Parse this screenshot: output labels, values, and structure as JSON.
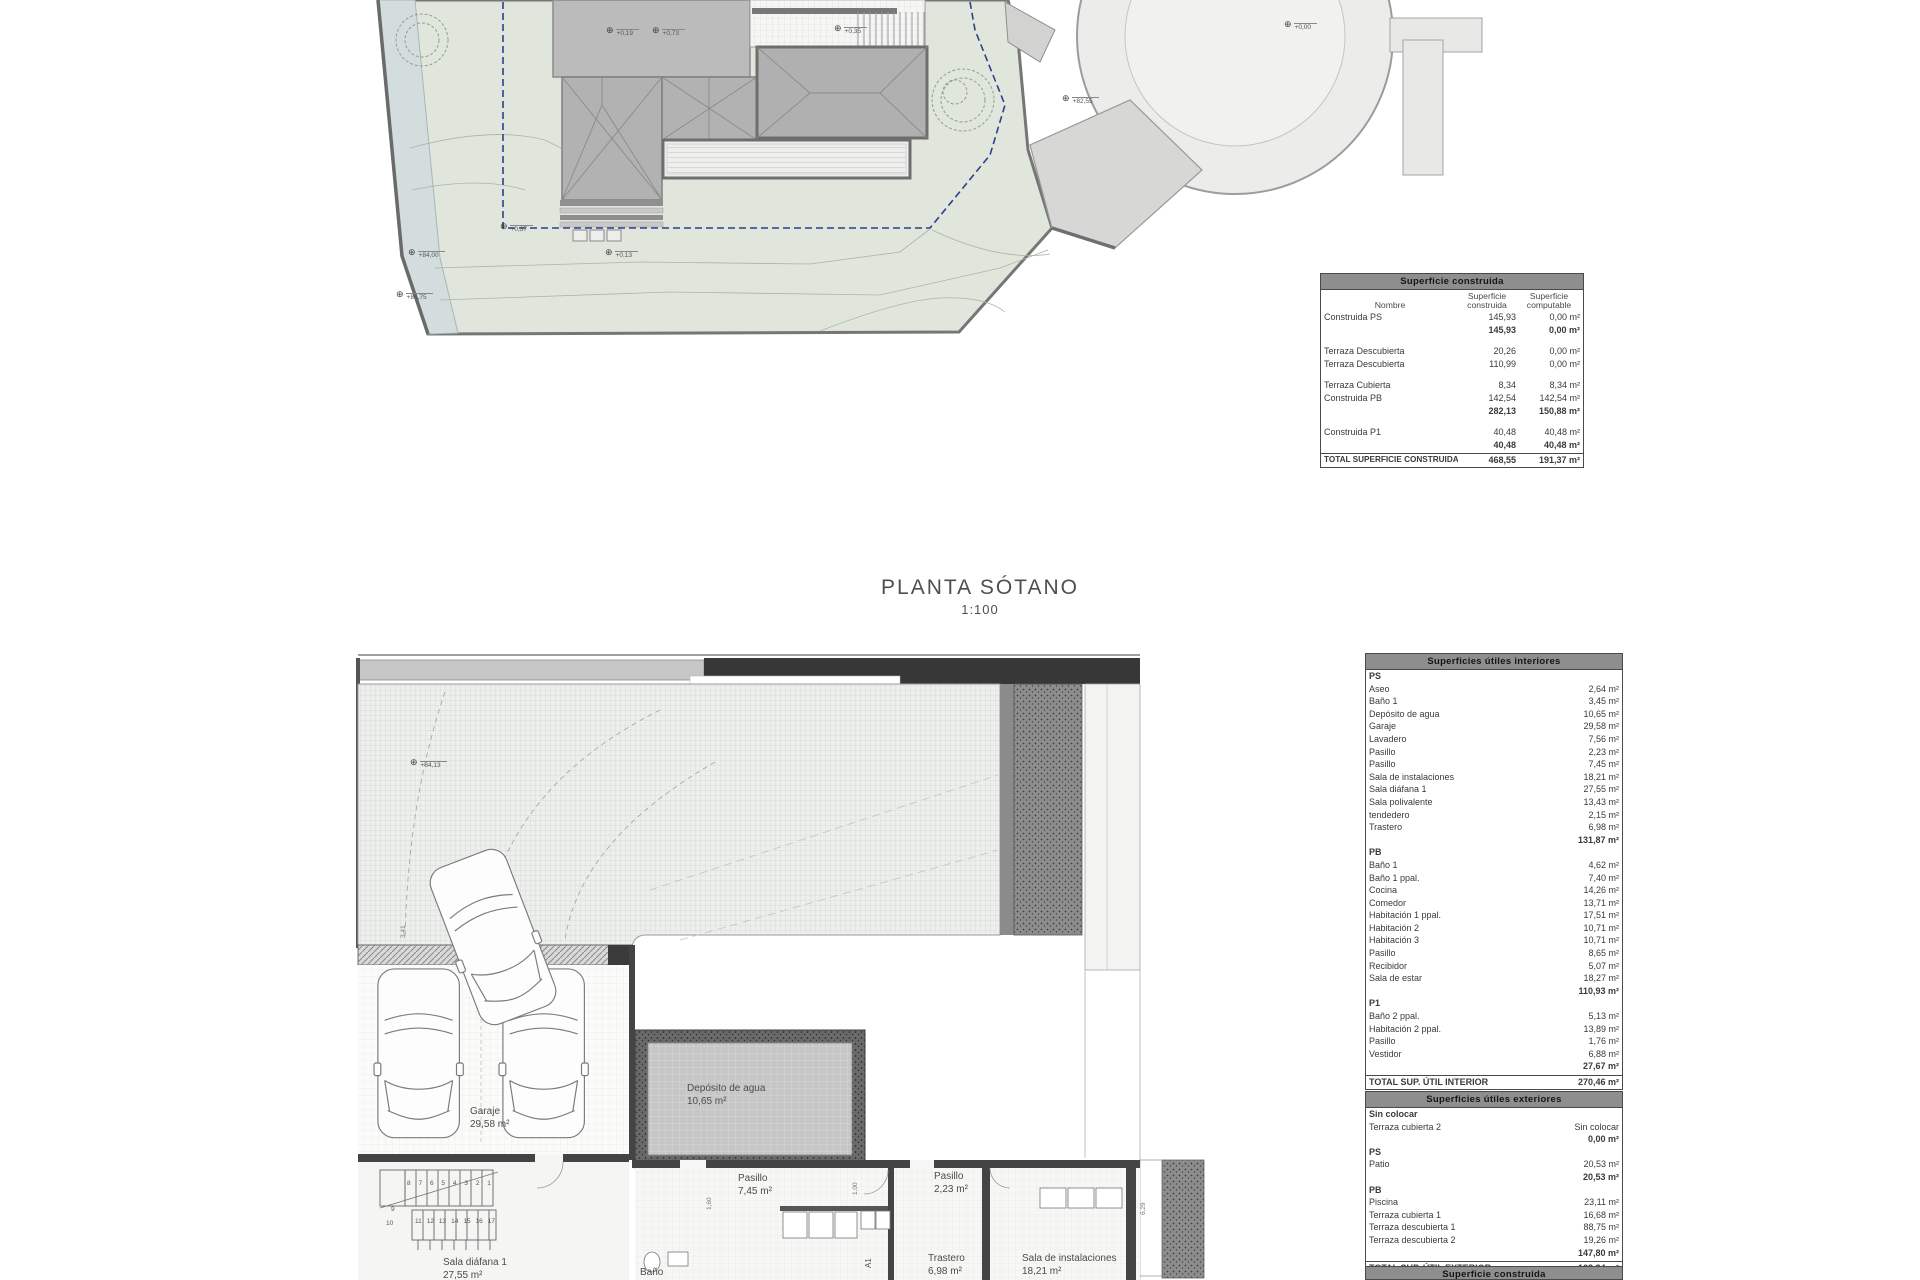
{
  "title": {
    "line1": "PLANTA SÓTANO",
    "line2": "1:100"
  },
  "colors": {
    "setback_dashed": "#2e3f8e",
    "site_green": "#e0e6dc",
    "stream": "#d4dddd",
    "table_header_bg": "#8e8e8e"
  },
  "site": {
    "markers": [
      {
        "label": "+0,19"
      },
      {
        "label": "+0,73"
      },
      {
        "label": "+0,35"
      },
      {
        "label": "+0,00"
      },
      {
        "label": "+82,55"
      },
      {
        "label": "+0,37"
      },
      {
        "label": "+84,00"
      },
      {
        "label": "+84,75"
      },
      {
        "label": "+0,13"
      }
    ]
  },
  "basement": {
    "marker": "+84,13",
    "labels": {
      "garaje": [
        "Garaje",
        "29,58 m²"
      ],
      "deposito": [
        "Depósito de agua",
        "10,65 m²"
      ],
      "pasillo_a": [
        "Pasillo",
        "7,45 m²"
      ],
      "pasillo_b": [
        "Pasillo",
        "2,23 m²"
      ],
      "bano": [
        "Baño"
      ],
      "trastero": [
        "Trastero",
        "6,98 m²"
      ],
      "sala_inst": [
        "Sala de instalaciones",
        "18,21 m²"
      ],
      "sala_diafana": [
        "Sala diáfana 1",
        "27,55 m²"
      ],
      "a1": "A1"
    },
    "stairs": {
      "f1": [
        "8",
        "7",
        "6",
        "5",
        "4",
        "3",
        "2",
        "1"
      ],
      "n9": "9",
      "n10": "10",
      "f2": [
        "11",
        "12",
        "13",
        "14",
        "15",
        "16",
        "17"
      ]
    },
    "dims": [
      "1,60",
      "1,00",
      "6,29",
      "3,41"
    ]
  },
  "tables": {
    "t1": {
      "title": "Superficie construida",
      "cols": [
        "Nombre",
        "Superficie construida",
        "Superficie computable"
      ],
      "rows": [
        {
          "t": "item",
          "n": "Construida PS",
          "a": "145,93",
          "b": "0,00 m²"
        },
        {
          "t": "sub",
          "n": "",
          "a": "145,93",
          "b": "0,00 m²"
        },
        {
          "t": "gap",
          "n": "",
          "a": "",
          "b": ""
        },
        {
          "t": "item",
          "n": "Terraza Descubierta",
          "a": "20,26",
          "b": "0,00 m²"
        },
        {
          "t": "item",
          "n": "Terraza Descubierta",
          "a": "110,99",
          "b": "0,00 m²"
        },
        {
          "t": "gap",
          "n": "",
          "a": "",
          "b": ""
        },
        {
          "t": "item",
          "n": "Terraza Cubierta",
          "a": "8,34",
          "b": "8,34 m²"
        },
        {
          "t": "item",
          "n": "Construida PB",
          "a": "142,54",
          "b": "142,54 m²"
        },
        {
          "t": "sub",
          "n": "",
          "a": "282,13",
          "b": "150,88 m²"
        },
        {
          "t": "gap",
          "n": "",
          "a": "",
          "b": ""
        },
        {
          "t": "item",
          "n": "Construida P1",
          "a": "40,48",
          "b": "40,48 m²"
        },
        {
          "t": "sub",
          "n": "",
          "a": "40,48",
          "b": "40,48 m²"
        },
        {
          "t": "total",
          "n": "TOTAL SUPERFICIE CONSTRUIDA:",
          "a": "468,55",
          "b": "191,37 m²"
        }
      ]
    },
    "t2": {
      "title": "Superficies útiles interiores",
      "rows": [
        {
          "t": "head",
          "n": "PS",
          "v": ""
        },
        {
          "t": "item",
          "n": "Aseo",
          "v": "2,64 m²"
        },
        {
          "t": "item",
          "n": "Baño 1",
          "v": "3,45 m²"
        },
        {
          "t": "item",
          "n": "Depósito de agua",
          "v": "10,65 m²"
        },
        {
          "t": "item",
          "n": "Garaje",
          "v": "29,58 m²"
        },
        {
          "t": "item",
          "n": "Lavadero",
          "v": "7,56 m²"
        },
        {
          "t": "item",
          "n": "Pasillo",
          "v": "2,23 m²"
        },
        {
          "t": "item",
          "n": "Pasillo",
          "v": "7,45 m²"
        },
        {
          "t": "item",
          "n": "Sala de instalaciones",
          "v": "18,21 m²"
        },
        {
          "t": "item",
          "n": "Sala diáfana 1",
          "v": "27,55 m²"
        },
        {
          "t": "item",
          "n": "Sala polivalente",
          "v": "13,43 m²"
        },
        {
          "t": "item",
          "n": "tendedero",
          "v": "2,15 m²"
        },
        {
          "t": "item",
          "n": "Trastero",
          "v": "6,98 m²"
        },
        {
          "t": "sub",
          "n": "",
          "v": "131,87 m²"
        },
        {
          "t": "head",
          "n": "PB",
          "v": ""
        },
        {
          "t": "item",
          "n": "Baño 1",
          "v": "4,62 m²"
        },
        {
          "t": "item",
          "n": "Baño 1 ppal.",
          "v": "7,40 m²"
        },
        {
          "t": "item",
          "n": "Cocina",
          "v": "14,26 m²"
        },
        {
          "t": "item",
          "n": "Comedor",
          "v": "13,71 m²"
        },
        {
          "t": "item",
          "n": "Habitación 1 ppal.",
          "v": "17,51 m²"
        },
        {
          "t": "item",
          "n": "Habitación 2",
          "v": "10,71 m²"
        },
        {
          "t": "item",
          "n": "Habitación 3",
          "v": "10,71 m²"
        },
        {
          "t": "item",
          "n": "Pasillo",
          "v": "8,65 m²"
        },
        {
          "t": "item",
          "n": "Recibidor",
          "v": "5,07 m²"
        },
        {
          "t": "item",
          "n": "Sala de estar",
          "v": "18,27 m²"
        },
        {
          "t": "sub",
          "n": "",
          "v": "110,93 m²"
        },
        {
          "t": "head",
          "n": "P1",
          "v": ""
        },
        {
          "t": "item",
          "n": "Baño 2 ppal.",
          "v": "5,13 m²"
        },
        {
          "t": "item",
          "n": "Habitación 2 ppal.",
          "v": "13,89 m²"
        },
        {
          "t": "item",
          "n": "Pasillo",
          "v": "1,76 m²"
        },
        {
          "t": "item",
          "n": "Vestidor",
          "v": "6,88 m²"
        },
        {
          "t": "sub",
          "n": "",
          "v": "27,67 m²"
        },
        {
          "t": "total",
          "n": "TOTAL SUP. ÚTIL INTERIOR",
          "v": "270,46 m²"
        }
      ]
    },
    "t3": {
      "title": "Superficies útiles exteriores",
      "rows": [
        {
          "t": "head",
          "n": "Sin colocar",
          "v": ""
        },
        {
          "t": "item",
          "n": "Terraza cubierta 2",
          "v": "Sin colocar"
        },
        {
          "t": "sub",
          "n": "",
          "v": "0,00 m²"
        },
        {
          "t": "head",
          "n": "PS",
          "v": ""
        },
        {
          "t": "item",
          "n": "Patio",
          "v": "20,53 m²"
        },
        {
          "t": "sub",
          "n": "",
          "v": "20,53 m²"
        },
        {
          "t": "head",
          "n": "PB",
          "v": ""
        },
        {
          "t": "item",
          "n": "Piscina",
          "v": "23,11 m²"
        },
        {
          "t": "item",
          "n": "Terraza cubierta 1",
          "v": "16,68 m²"
        },
        {
          "t": "item",
          "n": "Terraza descubierta 1",
          "v": "88,75 m²"
        },
        {
          "t": "item",
          "n": "Terraza descubierta 2",
          "v": "19,26 m²"
        },
        {
          "t": "sub",
          "n": "",
          "v": "147,80 m²"
        },
        {
          "t": "total",
          "n": "TOTAL SUP. ÚTIL EXTERIOR",
          "v": "168,34 m²"
        }
      ]
    },
    "t4": {
      "title": "Superficie construida"
    }
  }
}
